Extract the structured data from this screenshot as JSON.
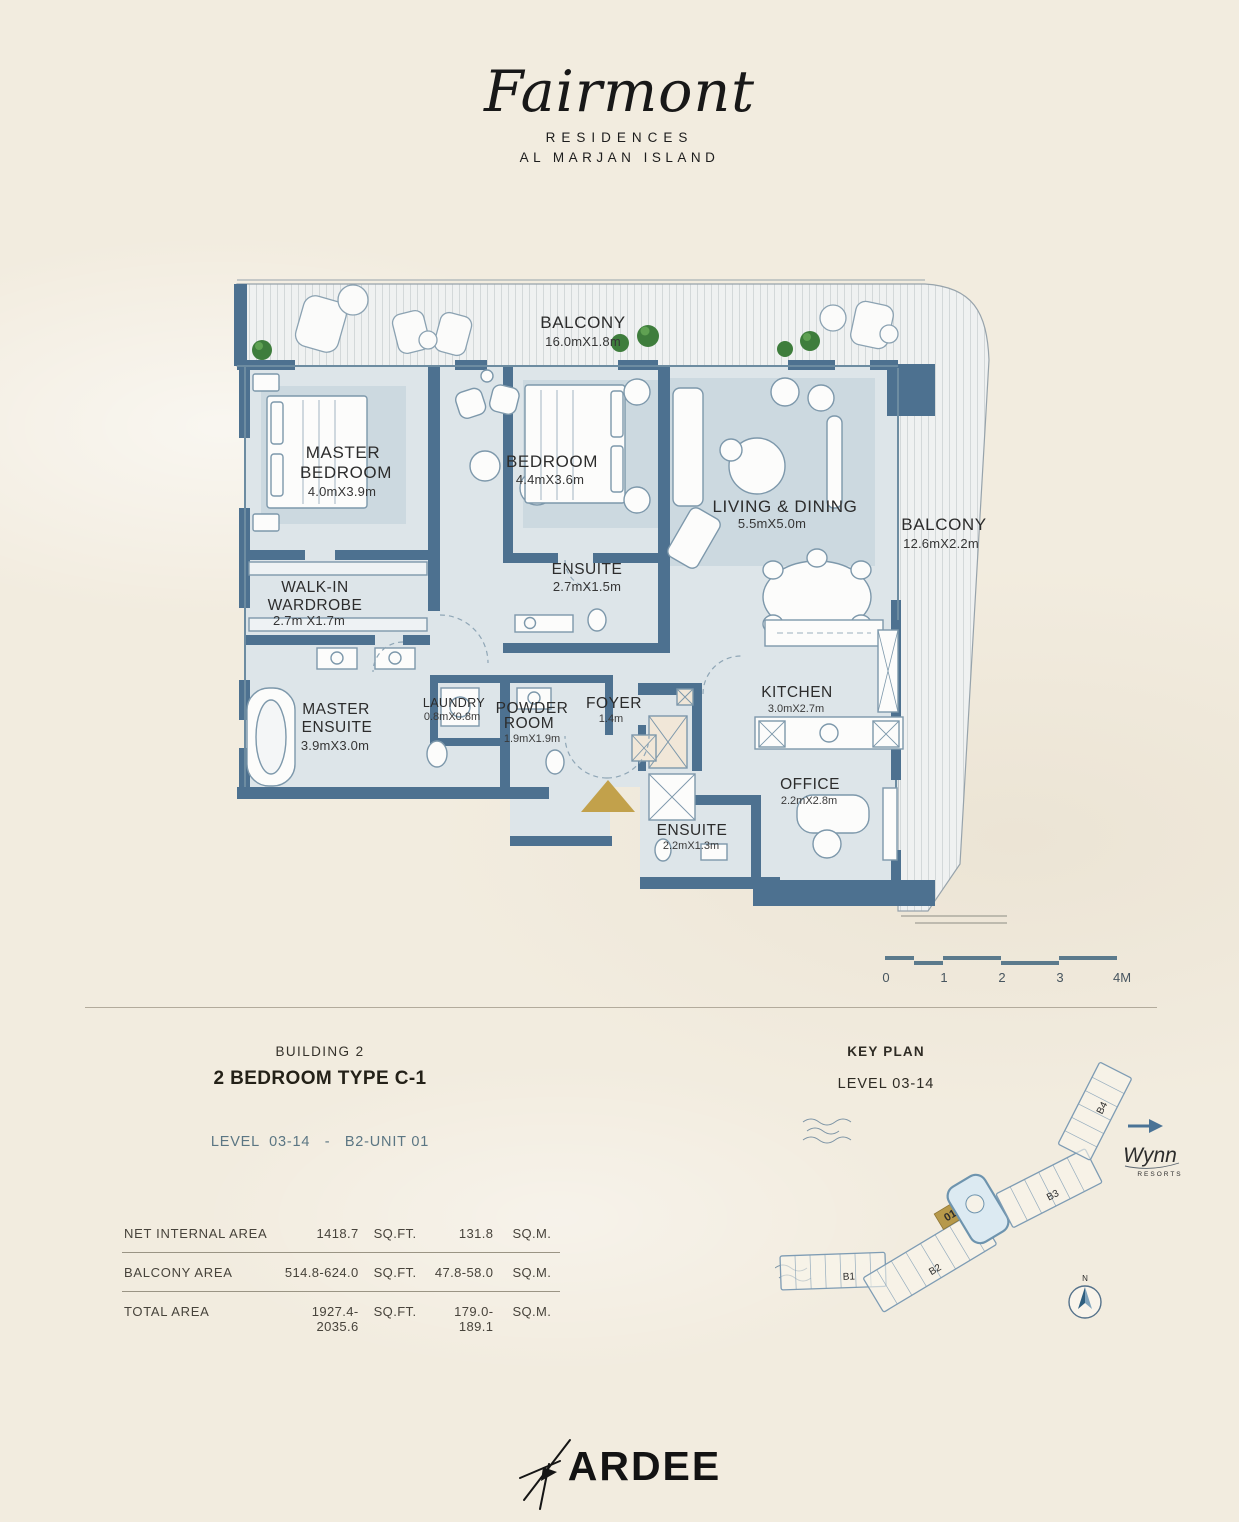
{
  "brand": {
    "script": "Fairmont",
    "line1": "RESIDENCES",
    "line2": "AL MARJAN ISLAND"
  },
  "plan": {
    "rooms": {
      "balcony_top": {
        "name": "BALCONY",
        "dims": "16.0mX1.8m"
      },
      "balcony_right": {
        "name": "BALCONY",
        "dims": "12.6mX2.2m"
      },
      "master_bedroom": {
        "line1": "MASTER",
        "line2": "BEDROOM",
        "dims": "4.0mX3.9m"
      },
      "bedroom": {
        "name": "BEDROOM",
        "dims": "4.4mX3.6m"
      },
      "living_dining": {
        "name": "LIVING & DINING",
        "dims": "5.5mX5.0m"
      },
      "walk_in_wardrobe": {
        "line1": "WALK-IN",
        "line2": "WARDROBE",
        "dims": "2.7m X1.7m"
      },
      "bedroom_ensuite": {
        "name": "ENSUITE",
        "dims": "2.7mX1.5m"
      },
      "master_ensuite": {
        "line1": "MASTER",
        "line2": "ENSUITE",
        "dims": "3.9mX3.0m"
      },
      "laundry": {
        "name": "LAUNDRY",
        "dims": "0.8mX0.8m"
      },
      "powder_room": {
        "line1": "POWDER",
        "line2": "ROOM",
        "dims": "1.9mX1.9m"
      },
      "foyer": {
        "name": "FOYER",
        "dims": "1.4m"
      },
      "kitchen": {
        "name": "KITCHEN",
        "dims": "3.0mX2.7m"
      },
      "office": {
        "name": "OFFICE",
        "dims": "2.2mX2.8m"
      },
      "office_ensuite": {
        "name": "ENSUITE",
        "dims": "2.2mX1.3m"
      }
    },
    "scale_labels": [
      "0",
      "1",
      "2",
      "3",
      "4M"
    ]
  },
  "unit_info": {
    "building": "BUILDING 2",
    "type": "2 BEDROOM TYPE C-1",
    "level_line": "LEVEL  03-14   -   B2-UNIT 01"
  },
  "areas": {
    "rows": [
      {
        "label": "NET INTERNAL AREA",
        "sqft": "1418.7",
        "sqft_unit": "SQ.FT.",
        "sqm": "131.8",
        "sqm_unit": "SQ.M."
      },
      {
        "label": "BALCONY AREA",
        "sqft": "514.8-624.0",
        "sqft_unit": "SQ.FT.",
        "sqm": "47.8-58.0",
        "sqm_unit": "SQ.M."
      },
      {
        "label": "TOTAL AREA",
        "sqft": "1927.4-2035.6",
        "sqft_unit": "SQ.FT.",
        "sqm": "179.0-189.1",
        "sqm_unit": "SQ.M."
      }
    ]
  },
  "key_plan": {
    "title": "KEY PLAN",
    "subtitle": "LEVEL 03-14",
    "buildings": [
      "B1",
      "B2",
      "B3",
      "B4"
    ],
    "unit_marker": "01",
    "wynn": "Wynn",
    "wynn_sub": "RESORTS",
    "compass_n": "N"
  },
  "footer": {
    "logo": "ARDEE"
  },
  "colors": {
    "wall": "#4d7190",
    "room_fill": "#dde5e9",
    "gold": "#c2a14b",
    "background": "#f2ecdf",
    "keyplan_stroke": "#7e9cb4"
  }
}
